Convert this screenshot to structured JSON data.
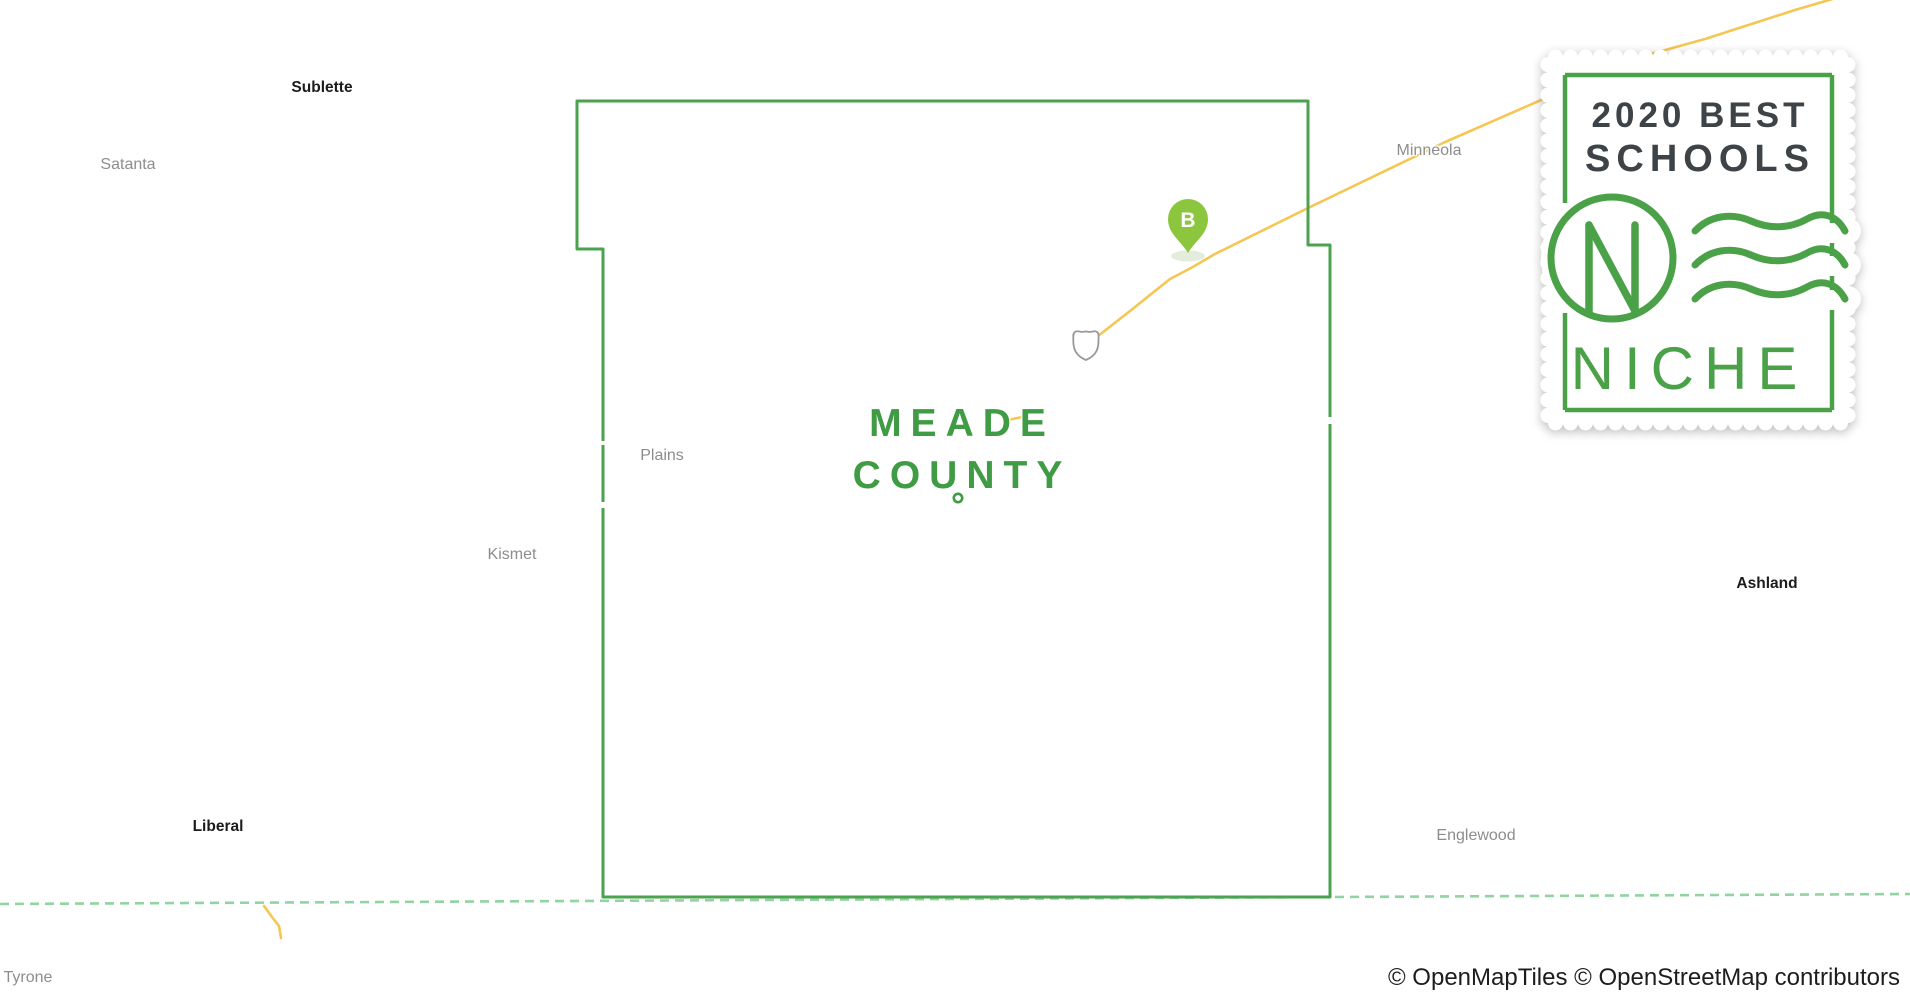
{
  "map": {
    "county_label": {
      "line1": "MEADE",
      "line2": "COUNTY"
    },
    "towns": [
      {
        "label": "Sublette",
        "emphasis": true
      },
      {
        "label": "Satanta",
        "emphasis": false
      },
      {
        "label": "Plains",
        "emphasis": false
      },
      {
        "label": "Kismet",
        "emphasis": false
      },
      {
        "label": "Liberal",
        "emphasis": true
      },
      {
        "label": "Tyrone",
        "emphasis": false
      },
      {
        "label": "Minneola",
        "emphasis": false
      },
      {
        "label": "Ashland",
        "emphasis": true
      },
      {
        "label": "Englewood",
        "emphasis": false
      }
    ],
    "marker": {
      "label": "B",
      "color": "#8cc63e"
    },
    "icons": [
      "school-marker-pin",
      "highway-shield-icon",
      "county-seat-dot"
    ],
    "colors": {
      "county_boundary": "#4ba24f",
      "county_label": "#3f9b44",
      "road": "#f5c653",
      "state_border_dash": "#90d4a2",
      "town_label": "#8d8d8d",
      "town_label_emphasis": "#1c1c1c"
    }
  },
  "badge": {
    "line1": "2020 BEST",
    "line2": "SCHOOLS",
    "brand": "NICHE",
    "logo_letter": "N",
    "green": "#4aa147",
    "text_color": "#3e4347"
  },
  "attribution": {
    "text": "© OpenMapTiles © OpenStreetMap contributors"
  }
}
